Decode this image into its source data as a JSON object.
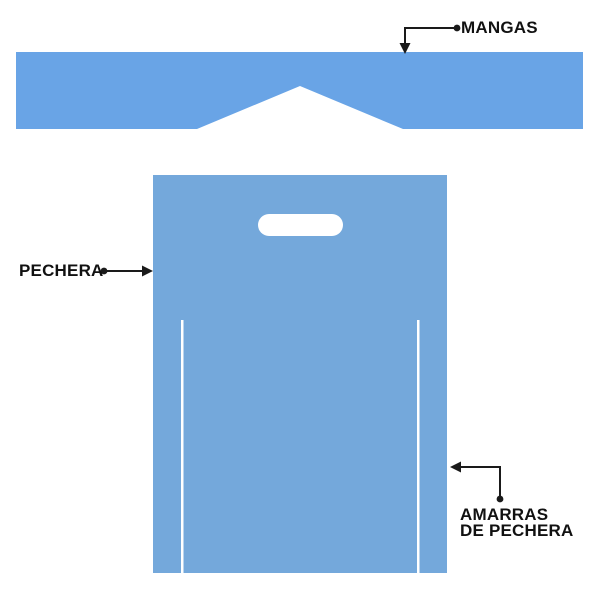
{
  "diagram": {
    "type": "labeled-garment-parts-diagram",
    "labels": {
      "mangas": "MANGAS",
      "pechera": "PECHERA",
      "amarras_line1": "AMARRAS",
      "amarras_line2": "DE PECHERA"
    }
  },
  "colors": {
    "sleeves_fill": "#69A4E6",
    "bib_fill": "#74A8DB",
    "cutout_fill": "#FFFFFF",
    "connector_color": "#1A1A1A",
    "label_text_color": "#111111",
    "background": "#FFFFFF"
  }
}
